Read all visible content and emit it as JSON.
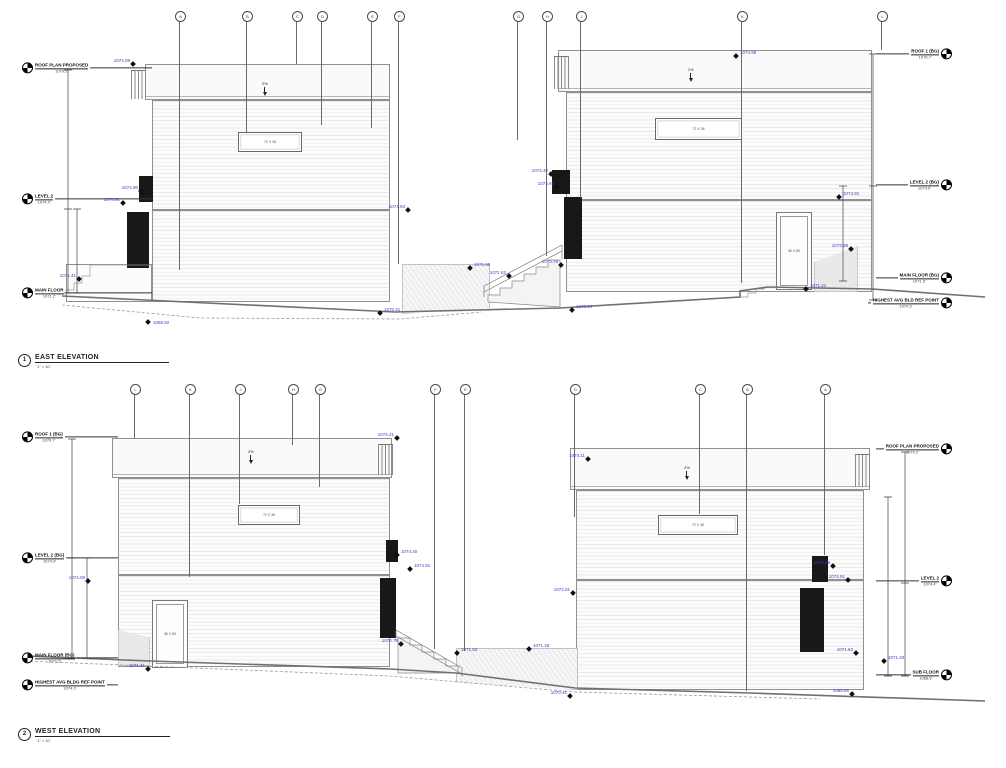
{
  "colors": {
    "spot_accent": "#4040c0",
    "linework": "#707070",
    "dark_glazing": "#181818"
  },
  "titles": {
    "east": {
      "num": "1",
      "label": "EAST ELEVATION",
      "scale": "1\" = 10'"
    },
    "west": {
      "num": "2",
      "label": "WEST ELEVATION",
      "scale": "1\" = 10'"
    }
  },
  "fragments": [
    {
      "y": 31,
      "t": "SECTIONS"
    },
    {
      "y": 52,
      "t": "TURE"
    },
    {
      "y": 58,
      "t": "TURF"
    },
    {
      "y": 100,
      "t": "WALL"
    }
  ],
  "east": {
    "bubbles": [
      {
        "x": 180,
        "h": 250,
        "g": "A"
      },
      {
        "x": 247,
        "h": 112,
        "g": "B"
      },
      {
        "x": 297,
        "h": 44,
        "g": "C"
      },
      {
        "x": 322,
        "h": 105,
        "g": "D"
      },
      {
        "x": 372,
        "h": 108,
        "g": "E"
      },
      {
        "x": 399,
        "h": 244,
        "g": "F"
      },
      {
        "x": 518,
        "h": 120,
        "g": "G"
      },
      {
        "x": 547,
        "h": 236,
        "g": "H"
      },
      {
        "x": 581,
        "h": 178,
        "g": "J"
      },
      {
        "x": 742,
        "h": 263,
        "g": "K"
      },
      {
        "x": 882,
        "h": 30,
        "g": "L"
      }
    ],
    "levels_left": [
      {
        "y": 68,
        "name": "ROOF PLAN PROPOSED",
        "elev": "1079.2'"
      },
      {
        "y": 199,
        "name": "LEVEL 2",
        "elev": "1074.4'"
      },
      {
        "y": 293,
        "name": "MAIN FLOOR",
        "elev": "1071.2'"
      }
    ],
    "levels_right": [
      {
        "y": 54,
        "name": "ROOF 1 (BG)",
        "elev": "1079.7'"
      },
      {
        "y": 185,
        "name": "LEVEL 2 (BG)",
        "elev": "1074.9'"
      },
      {
        "y": 278,
        "name": "MAIN FLOOR (BG)",
        "elev": "1071.5'"
      },
      {
        "y": 303,
        "name": "HIGHEST AVG BLD REF POINT",
        "elev": "1074.3'"
      }
    ],
    "spots": [
      {
        "x": 133,
        "y": 64,
        "v": "1074.08",
        "s": "tl"
      },
      {
        "x": 141,
        "y": 191,
        "v": "1074.90",
        "s": "tl"
      },
      {
        "x": 123,
        "y": 203,
        "v": "1074.91",
        "s": "tl"
      },
      {
        "x": 79,
        "y": 279,
        "v": "1071.41",
        "s": "tl"
      },
      {
        "x": 148,
        "y": 322,
        "v": "1068.92",
        "s": "r"
      },
      {
        "x": 408,
        "y": 210,
        "v": "1074.93",
        "s": "tl"
      },
      {
        "x": 470,
        "y": 268,
        "v": "1071.99",
        "s": "tr"
      },
      {
        "x": 509,
        "y": 276,
        "v": "1071.63",
        "s": "tl"
      },
      {
        "x": 561,
        "y": 265,
        "v": "1073.79",
        "s": "tl"
      },
      {
        "x": 380,
        "y": 313,
        "v": "1070.41",
        "s": "tr"
      },
      {
        "x": 572,
        "y": 310,
        "v": "1070.14",
        "s": "tr"
      },
      {
        "x": 736,
        "y": 56,
        "v": "1074.99",
        "s": "tr"
      },
      {
        "x": 839,
        "y": 197,
        "v": "1074.91",
        "s": "tr"
      },
      {
        "x": 851,
        "y": 249,
        "v": "1073.99",
        "s": "tl"
      },
      {
        "x": 806,
        "y": 289,
        "v": "1071.21",
        "s": "tr"
      },
      {
        "x": 551,
        "y": 174,
        "v": "1074.40",
        "s": "tl"
      },
      {
        "x": 557,
        "y": 187,
        "v": "1074.91",
        "s": "tl"
      }
    ],
    "windows": [
      {
        "x": 238,
        "y": 132,
        "w": 64,
        "ht": 20,
        "label": "72 X 36"
      },
      {
        "x": 655,
        "y": 118,
        "w": 87,
        "ht": 22,
        "label": "72 X 36"
      }
    ],
    "door": {
      "label": "36 X 80"
    },
    "slopes": [
      {
        "x": 262,
        "y": 82,
        "label": "2%"
      },
      {
        "x": 688,
        "y": 68,
        "label": "2%"
      }
    ]
  },
  "west": {
    "bubbles": [
      {
        "x": 135,
        "h": 46,
        "g": "L"
      },
      {
        "x": 190,
        "h": 184,
        "g": "K"
      },
      {
        "x": 240,
        "h": 111,
        "g": "J"
      },
      {
        "x": 293,
        "h": 52,
        "g": "H"
      },
      {
        "x": 320,
        "h": 94,
        "g": "G"
      },
      {
        "x": 435,
        "h": 256,
        "g": "F"
      },
      {
        "x": 465,
        "h": 258,
        "g": "E"
      },
      {
        "x": 575,
        "h": 124,
        "g": "D"
      },
      {
        "x": 700,
        "h": 121,
        "g": "C"
      },
      {
        "x": 747,
        "h": 298,
        "g": "B"
      },
      {
        "x": 825,
        "h": 162,
        "g": "A"
      }
    ],
    "levels_left": [
      {
        "y": 437,
        "name": "ROOF 1 (BG)",
        "elev": "1079.7'"
      },
      {
        "y": 558,
        "name": "LEVEL 2 (BG)",
        "elev": "1074.9'"
      },
      {
        "y": 658,
        "name": "MAIN FLOOR (BG)",
        "elev": "1071.5'"
      },
      {
        "y": 685,
        "name": "HIGHEST AVG BLDG REF POINT",
        "elev": "1074.3'"
      }
    ],
    "levels_right": [
      {
        "y": 449,
        "name": "ROOF PLAN PROPOSED",
        "elev": "1079.2'"
      },
      {
        "y": 581,
        "name": "LEVEL 2",
        "elev": "1074.4'"
      },
      {
        "y": 675,
        "name": "SUB FLOOR",
        "elev": "1068.9'"
      }
    ],
    "spots": [
      {
        "x": 397,
        "y": 438,
        "v": "1074.41",
        "s": "tl"
      },
      {
        "x": 588,
        "y": 459,
        "v": "1074.11",
        "s": "tl"
      },
      {
        "x": 88,
        "y": 581,
        "v": "1074.08",
        "s": "tl"
      },
      {
        "x": 397,
        "y": 555,
        "v": "1074.40",
        "s": "tr"
      },
      {
        "x": 410,
        "y": 569,
        "v": "1074.91",
        "s": "tr"
      },
      {
        "x": 401,
        "y": 644,
        "v": "1073.79",
        "s": "tl"
      },
      {
        "x": 457,
        "y": 653,
        "v": "1071.63",
        "s": "tr"
      },
      {
        "x": 529,
        "y": 649,
        "v": "1071.28",
        "s": "tr"
      },
      {
        "x": 573,
        "y": 593,
        "v": "1074.01",
        "s": "tl"
      },
      {
        "x": 570,
        "y": 696,
        "v": "1070.41",
        "s": "tl"
      },
      {
        "x": 148,
        "y": 669,
        "v": "1071.41",
        "s": "tl"
      },
      {
        "x": 833,
        "y": 566,
        "v": "1074.08",
        "s": "tl"
      },
      {
        "x": 848,
        "y": 580,
        "v": "1074.91",
        "s": "tl"
      },
      {
        "x": 856,
        "y": 653,
        "v": "1071.63",
        "s": "tl"
      },
      {
        "x": 884,
        "y": 661,
        "v": "1071.20",
        "s": "tr"
      },
      {
        "x": 852,
        "y": 694,
        "v": "1069.86",
        "s": "tl"
      }
    ],
    "windows": [
      {
        "x": 238,
        "y": 505,
        "w": 62,
        "ht": 20,
        "label": "72 X 36"
      },
      {
        "x": 658,
        "y": 515,
        "w": 80,
        "ht": 20,
        "label": "72 X 36"
      }
    ],
    "door": {
      "label": "36 X 80"
    },
    "slopes": [
      {
        "x": 248,
        "y": 450,
        "label": "2%"
      },
      {
        "x": 684,
        "y": 466,
        "label": "2%"
      }
    ]
  }
}
